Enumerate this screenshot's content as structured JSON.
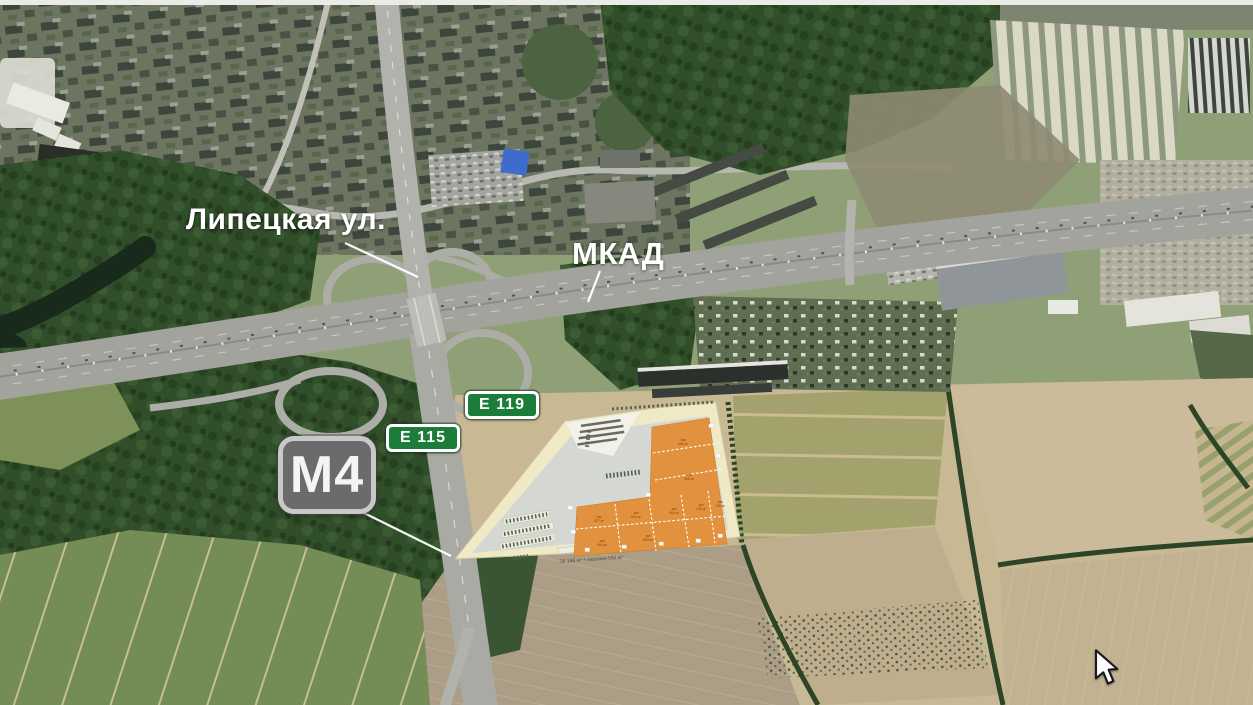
{
  "map": {
    "kind": "satellite-aerial",
    "annotations": {
      "street_label": "Липецкая ул.",
      "ring_road_label": "МКАД"
    },
    "road_signs": {
      "e119": {
        "label": "E 119",
        "type": "european-route",
        "color": "#1c7c39"
      },
      "e115": {
        "label": "E 115",
        "type": "european-route",
        "color": "#1c7c39"
      },
      "m4": {
        "label": "M4",
        "type": "federal-highway",
        "color": "#6b6b6d"
      }
    },
    "site_plan": {
      "building_color": "#e2913e",
      "base_color": "#efe9c6",
      "caption": "36 166 м² + мезонин 592 м²",
      "units": [
        {
          "id": "101",
          "area": "327 м²"
        },
        {
          "id": "102",
          "area": "653 м²"
        },
        {
          "id": "103",
          "area": "656 м²"
        },
        {
          "id": "104",
          "area": "136 м²"
        },
        {
          "id": "105",
          "area": "136 м²"
        },
        {
          "id": "106",
          "area": "654 м²"
        },
        {
          "id": "107",
          "area": "653 м²"
        },
        {
          "id": "108",
          "area": "655 м²"
        },
        {
          "id": "109",
          "area": "656 м²"
        }
      ]
    },
    "cursor": {
      "type": "arrow"
    },
    "palette": {
      "label_text": "#ffffff",
      "sign_green": "#1c7c39",
      "sign_gray": "#6b6b6d",
      "highway_asphalt": "#a3a39d",
      "forest": "#314e2a",
      "field_tan": "#c8b894"
    }
  }
}
